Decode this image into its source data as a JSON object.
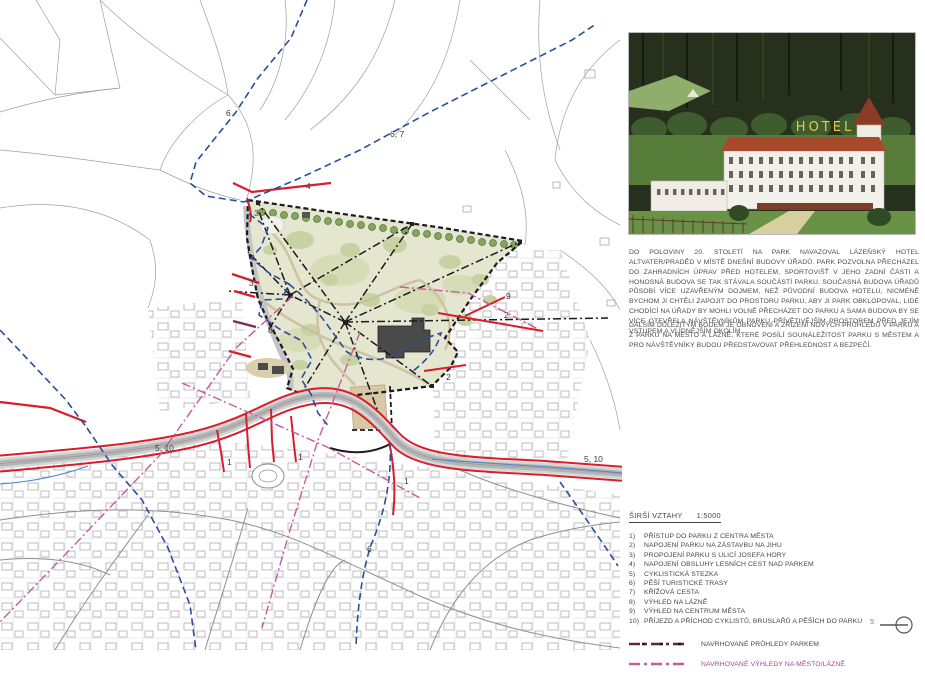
{
  "page": {
    "number": "5"
  },
  "photo": {
    "caption": "historic postcard of spa hotel",
    "hotel_sign": "HOTEL"
  },
  "text": {
    "paragraph1": "DO POLOVINY 20. STOLETÍ NA PARK NAVAZOVAL LÁZEŇSKÝ HOTEL ALTVATER/PRADĚD V MÍSTĚ DNEŠNÍ BUDOVY ÚŘADŮ. PARK POZVOLNA PŘECHÁZEL DO ZAHRADNÍCH ÚPRAV PŘED HOTELEM, SPORTOVIŠŤ V JEHO ZADNÍ ČÁSTI A HONOSNÁ BUDOVA SE TAK STÁVALA SOUČÁSTÍ PARKU. SOUČASNÁ BUDOVA ÚŘADŮ PŮSOBÍ VÍCE UZAVŘENÝM DOJMEM, NEŽ PŮVODNÍ BUDOVA HOTELU, NICMÉNĚ BYCHOM JI CHTĚLI ZAPOJIT DO PROSTORU PARKU, ABY JI PARK OBKLOPOVAL, LIDÉ CHODÍCÍ NA ÚŘADY BY MOHLI VOLNĚ PŘECHÁZET DO PARKU A SAMA BUDOVA BY SE VÍCE OTEVŘELA NÁVŠTĚVNÍKŮM PARKU PŘÍVĚTIVĚJŠÍM PROSTOREM PŘED JEJÍM VSTUPEM A VLÍDNĚJŠÍM OKOLÍM.",
    "paragraph2": "DALŠÍM DŮLEŽITÝM BODEM JE OBNOVENÍ A ZŘÍZENÍ NOVÝCH PRŮHLEDŮ V PARKU A Z PARKU NA MĚSTO A LÁZNĚ, KTERÉ POSÍLÍ SOUNÁLEŽITOST PARKU S MĚSTEM A PRO NÁVŠTĚVNÍKY BUDOU PŘEDSTAVOVAT PŘEHLEDNOST A BEZPEČÍ."
  },
  "legend": {
    "title": "ŠIRŠÍ VZTAHY",
    "scale": "1:5000",
    "items": [
      {
        "num": "1)",
        "label": "PŘÍSTUP DO PARKU Z CENTRA MĚSTA"
      },
      {
        "num": "2)",
        "label": "NAPOJENÍ PARKU NA ZÁSTAVBU NA JIHU"
      },
      {
        "num": "3)",
        "label": "PROPOJENÍ PARKU S ULICÍ JOSEFA HORY"
      },
      {
        "num": "4)",
        "label": "NAPOJENÍ OBSLUHY LESNÍCH CEST NAD PARKEM"
      },
      {
        "num": "5)",
        "label": "CYKLISTICKÁ STEZKA"
      },
      {
        "num": "6)",
        "label": "PĚŠÍ TURISTICKÉ TRASY"
      },
      {
        "num": "7)",
        "label": "KŘÍŽOVÁ CESTA"
      },
      {
        "num": "8)",
        "label": "VÝHLED NA LÁZNĚ"
      },
      {
        "num": "9)",
        "label": "VÝHLED NA CENTRUM MĚSTA"
      },
      {
        "num": "10)",
        "label": "PŘÍJEZD A PŘÍCHOD CYKLISTŮ, BRUSLAŘŮ A PĚŠÍCH DO PARKU"
      }
    ],
    "lines": [
      {
        "label": "NAVRHOVANÉ PRŮHLEDY PARKEM",
        "color": "#6d1f2c"
      },
      {
        "label": "NAVRHOVANÉ VÝHLEDY NA MĚSTO/LÁZNĚ",
        "color": "#c85a9e"
      }
    ]
  },
  "map": {
    "scale_note": "site plan 1:5000 with park, routes and view axes",
    "colors": {
      "road_red": "#d81e2c",
      "route_blue": "#2b4d9c",
      "view_magenta": "#c85a9e",
      "park_base": "#e4e6d0",
      "boundary_black": "#1a1a1a"
    },
    "labels": [
      {
        "text": "6"
      },
      {
        "text": "6, 7"
      },
      {
        "text": "4"
      },
      {
        "text": "3"
      },
      {
        "text": "3"
      },
      {
        "text": "8"
      },
      {
        "text": "9"
      },
      {
        "text": "2"
      },
      {
        "text": "2"
      },
      {
        "text": "5, 10"
      },
      {
        "text": "5, 10"
      },
      {
        "text": "1"
      },
      {
        "text": "1"
      },
      {
        "text": "1"
      },
      {
        "text": "6"
      }
    ]
  }
}
